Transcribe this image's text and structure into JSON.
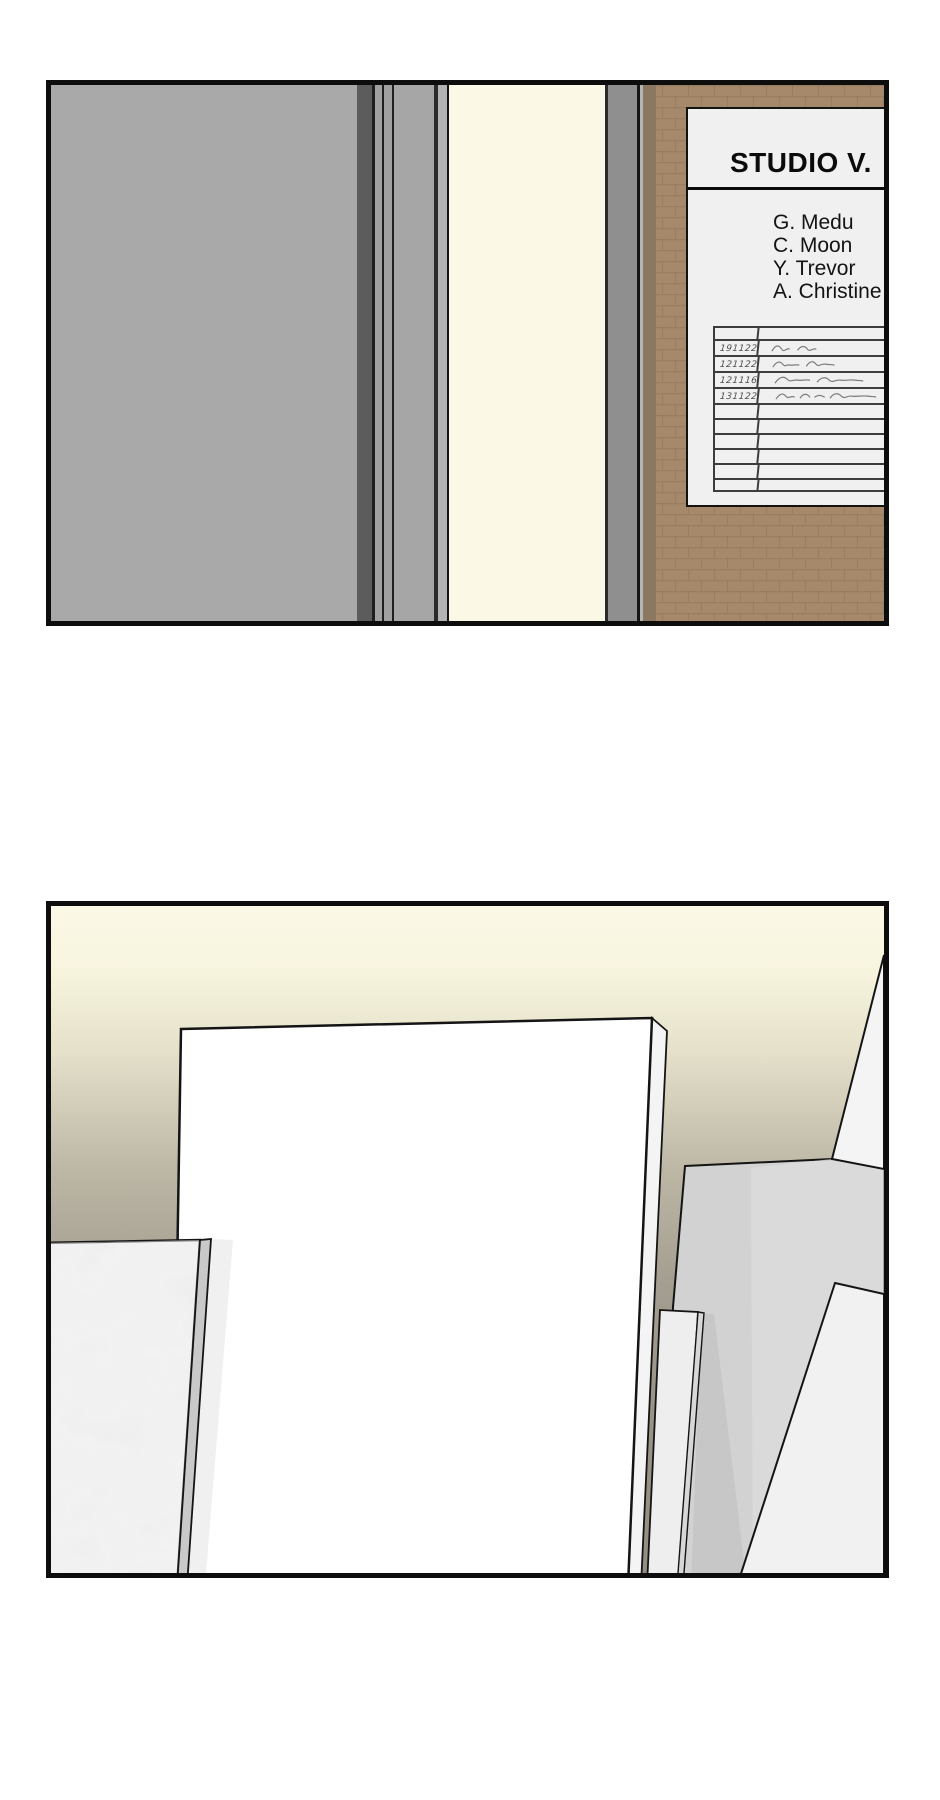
{
  "page": {
    "kind": "comic-page",
    "panel_count": 2,
    "background": "#ffffff",
    "panel_border": "#0d0d0d"
  },
  "panel1": {
    "scene": "studio hallway door with name sign on brick wall",
    "colors": {
      "wall_gray": "#a9a9a9",
      "door_light": "#fbf9e6",
      "frame_gray": "#8f8f8f",
      "brick_wall": "#a5896a",
      "brick_line": "#8b7154",
      "sign_bg": "#f0f0f0",
      "table_line": "#3c3c3c"
    },
    "strips": [
      {
        "name": "wall-left",
        "x": 0,
        "w": 306,
        "color": "#a9a9a9"
      },
      {
        "name": "frame-shadow",
        "x": 306,
        "w": 15,
        "color": "#5c5c5c"
      },
      {
        "name": "frame-line-a",
        "x": 321,
        "w": 3,
        "color": "#1f1f1f"
      },
      {
        "name": "frame-strip-a",
        "x": 324,
        "w": 7,
        "color": "#a0a0a0"
      },
      {
        "name": "frame-line-b",
        "x": 331,
        "w": 2,
        "color": "#1f1f1f"
      },
      {
        "name": "frame-strip-b",
        "x": 333,
        "w": 8,
        "color": "#a0a0a0"
      },
      {
        "name": "frame-line-c",
        "x": 341,
        "w": 2,
        "color": "#1f1f1f"
      },
      {
        "name": "door-edge",
        "x": 343,
        "w": 40,
        "color": "#a6a6a6"
      },
      {
        "name": "frame-line-d",
        "x": 383,
        "w": 4,
        "color": "#2a2a2a"
      },
      {
        "name": "frame-strip-c",
        "x": 387,
        "w": 9,
        "color": "#b3b3b3"
      },
      {
        "name": "frame-line-e",
        "x": 396,
        "w": 2,
        "color": "#141414"
      },
      {
        "name": "door-light-gap",
        "x": 398,
        "w": 156,
        "color": "#fbf9e6"
      },
      {
        "name": "frame-line-f",
        "x": 554,
        "w": 3,
        "color": "#2a2a2a"
      },
      {
        "name": "frame-right",
        "x": 557,
        "w": 29,
        "color": "#8f8f8f"
      },
      {
        "name": "frame-line-g",
        "x": 586,
        "w": 3,
        "color": "#161616"
      },
      {
        "name": "wall-sliver",
        "x": 589,
        "w": 3,
        "color": "#b5b5b5"
      },
      {
        "name": "wall-shadow-band",
        "x": 592,
        "w": 13,
        "color": "#8a7861"
      }
    ],
    "sign": {
      "title": "STUDIO V.",
      "members": [
        "G. Medu",
        "C. Moon",
        "Y. Trevor",
        "A. Christine"
      ],
      "logbook": {
        "rows": [
          {
            "date": "",
            "signed": false
          },
          {
            "date": "191122",
            "signed": true,
            "sig": 0
          },
          {
            "date": "121122",
            "signed": true,
            "sig": 1
          },
          {
            "date": "121116",
            "signed": true,
            "sig": 2
          },
          {
            "date": "131122",
            "signed": true,
            "sig": 3
          },
          {
            "date": "",
            "signed": false
          },
          {
            "date": "",
            "signed": false
          },
          {
            "date": "",
            "signed": false
          },
          {
            "date": "",
            "signed": false
          },
          {
            "date": "",
            "signed": false
          },
          {
            "date": "",
            "signed": false
          }
        ]
      }
    }
  },
  "panel2": {
    "scene": "studio interior with blank canvases and boards leaning against a wall",
    "colors": {
      "wall_top": "#fbf8e6",
      "wall_bottom": "#948e82",
      "canvas_white": "#ffffff",
      "board_gray": "#d2d2d2",
      "board_light": "#eeeeee",
      "marble_board": "#e9e9e9",
      "edge_line": "#141414"
    }
  }
}
